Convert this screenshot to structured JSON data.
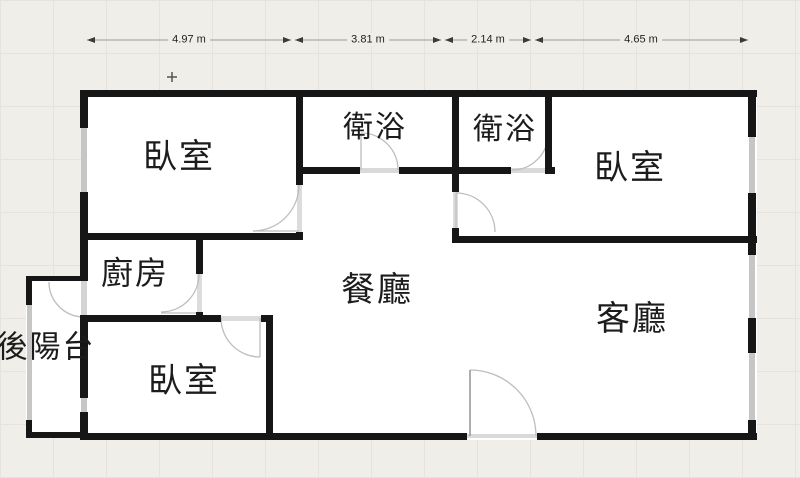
{
  "plan": {
    "rooms": [
      {
        "id": "bedroom-top-left",
        "label": "臥室"
      },
      {
        "id": "bathroom-left",
        "label": "衛浴"
      },
      {
        "id": "bathroom-right",
        "label": "衛浴"
      },
      {
        "id": "bedroom-right",
        "label": "臥室"
      },
      {
        "id": "kitchen",
        "label": "廚房"
      },
      {
        "id": "dining-room",
        "label": "餐廳"
      },
      {
        "id": "living-room",
        "label": "客廳"
      },
      {
        "id": "bedroom-bottom-left",
        "label": "臥室"
      },
      {
        "id": "back-balcony",
        "label": "後陽台"
      }
    ],
    "dimensions": [
      {
        "label": "4.97 m"
      },
      {
        "label": "3.81 m"
      },
      {
        "label": "2.14 m"
      },
      {
        "label": "4.65 m"
      }
    ],
    "colors": {
      "wall": "#161616",
      "window": "#c6c6c6",
      "door_arc": "#bdbdbd",
      "floor": "#ffffff",
      "background": "#f0eee8"
    }
  }
}
